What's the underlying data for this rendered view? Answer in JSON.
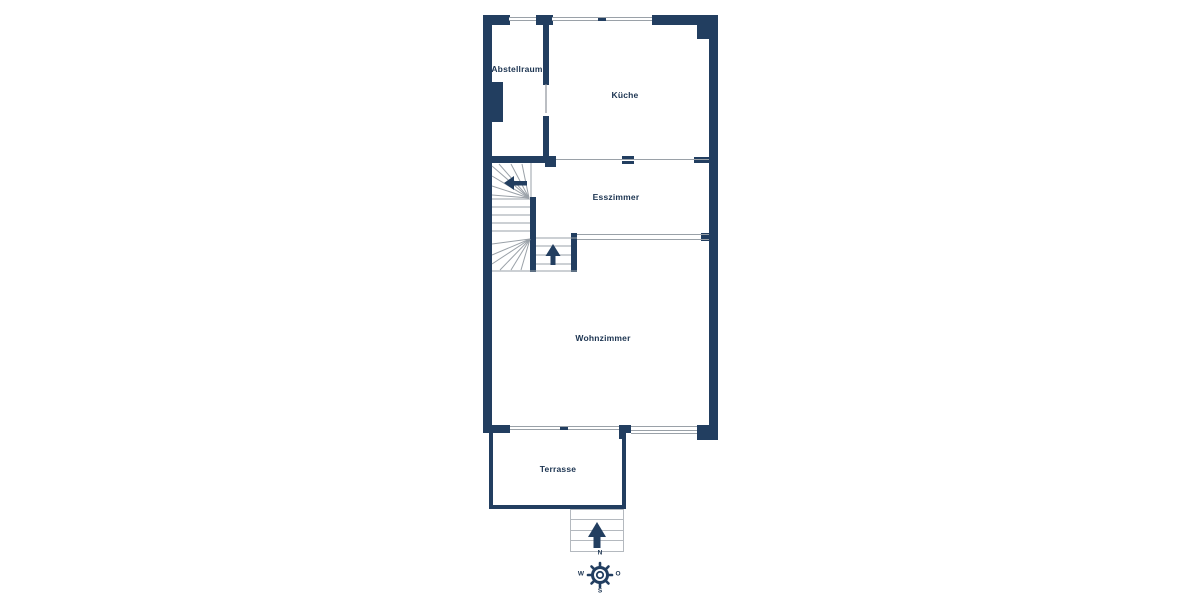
{
  "colors": {
    "wall": "#223e60",
    "text": "#1b3350",
    "line": "#9aa1a8",
    "steps": "#b4b9bf",
    "bg": "#ffffff"
  },
  "rooms": {
    "abstellraum": {
      "label": "Abstellraum"
    },
    "kueche": {
      "label": "Küche"
    },
    "esszimmer": {
      "label": "Esszimmer"
    },
    "wohnzimmer": {
      "label": "Wohnzimmer"
    },
    "terrasse": {
      "label": "Terrasse"
    }
  },
  "compass": {
    "north": "N",
    "west": "W",
    "east": "O",
    "south": "S"
  },
  "icons": {
    "stair_up_arrow": "arrow-up",
    "stair_entry_arrow": "arrow-left",
    "terrace_steps_arrow": "arrow-up",
    "compass_rose": "compass-rose-icon"
  }
}
